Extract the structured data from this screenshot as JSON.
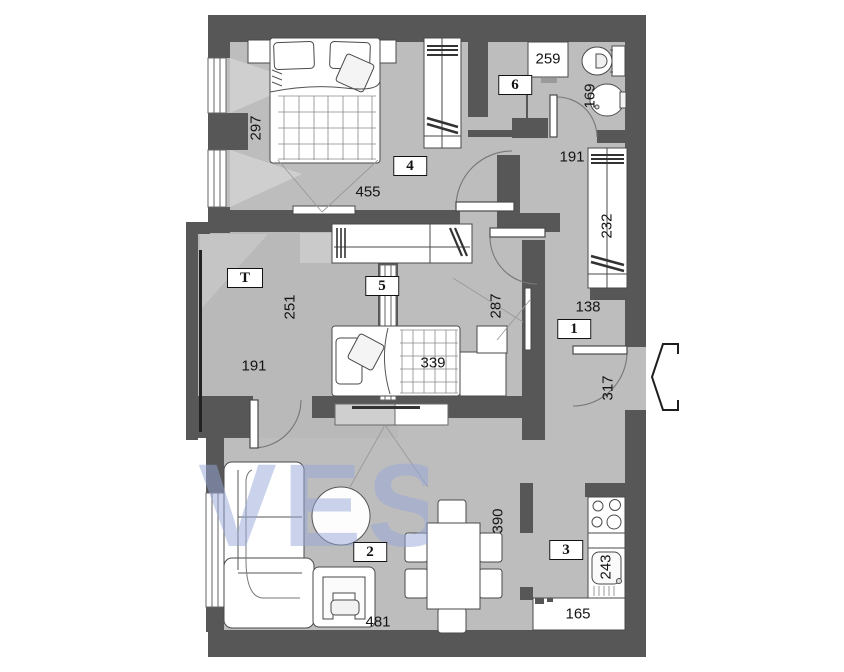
{
  "title": "apartment-floor-plan",
  "colors": {
    "wall": "#575757",
    "floor": "#bdbdbd",
    "terrace_floor": "#b9b9b9",
    "furniture": "#ffffff",
    "watermark": "rgba(150,168,215,0.5)"
  },
  "watermark": "VES",
  "rooms": {
    "hallway": "1",
    "living": "2",
    "kitchen": "3",
    "bedroom": "4",
    "kids_room": "5",
    "bathroom": "6",
    "terrace": "T"
  },
  "dimensions": {
    "room4_height": "297",
    "room4_width": "455",
    "bath_width": "259",
    "bath_sink": "169",
    "hall_top": "191",
    "wardrobe_right": "232",
    "hall_width": "138",
    "entrance": "317",
    "room5_height": "287",
    "room5_bed": "339",
    "terrace_height": "251",
    "terrace_width": "191",
    "living_width": "481",
    "living_height": "390",
    "kitchen_sink": "243",
    "kitchen_counter": "165"
  }
}
